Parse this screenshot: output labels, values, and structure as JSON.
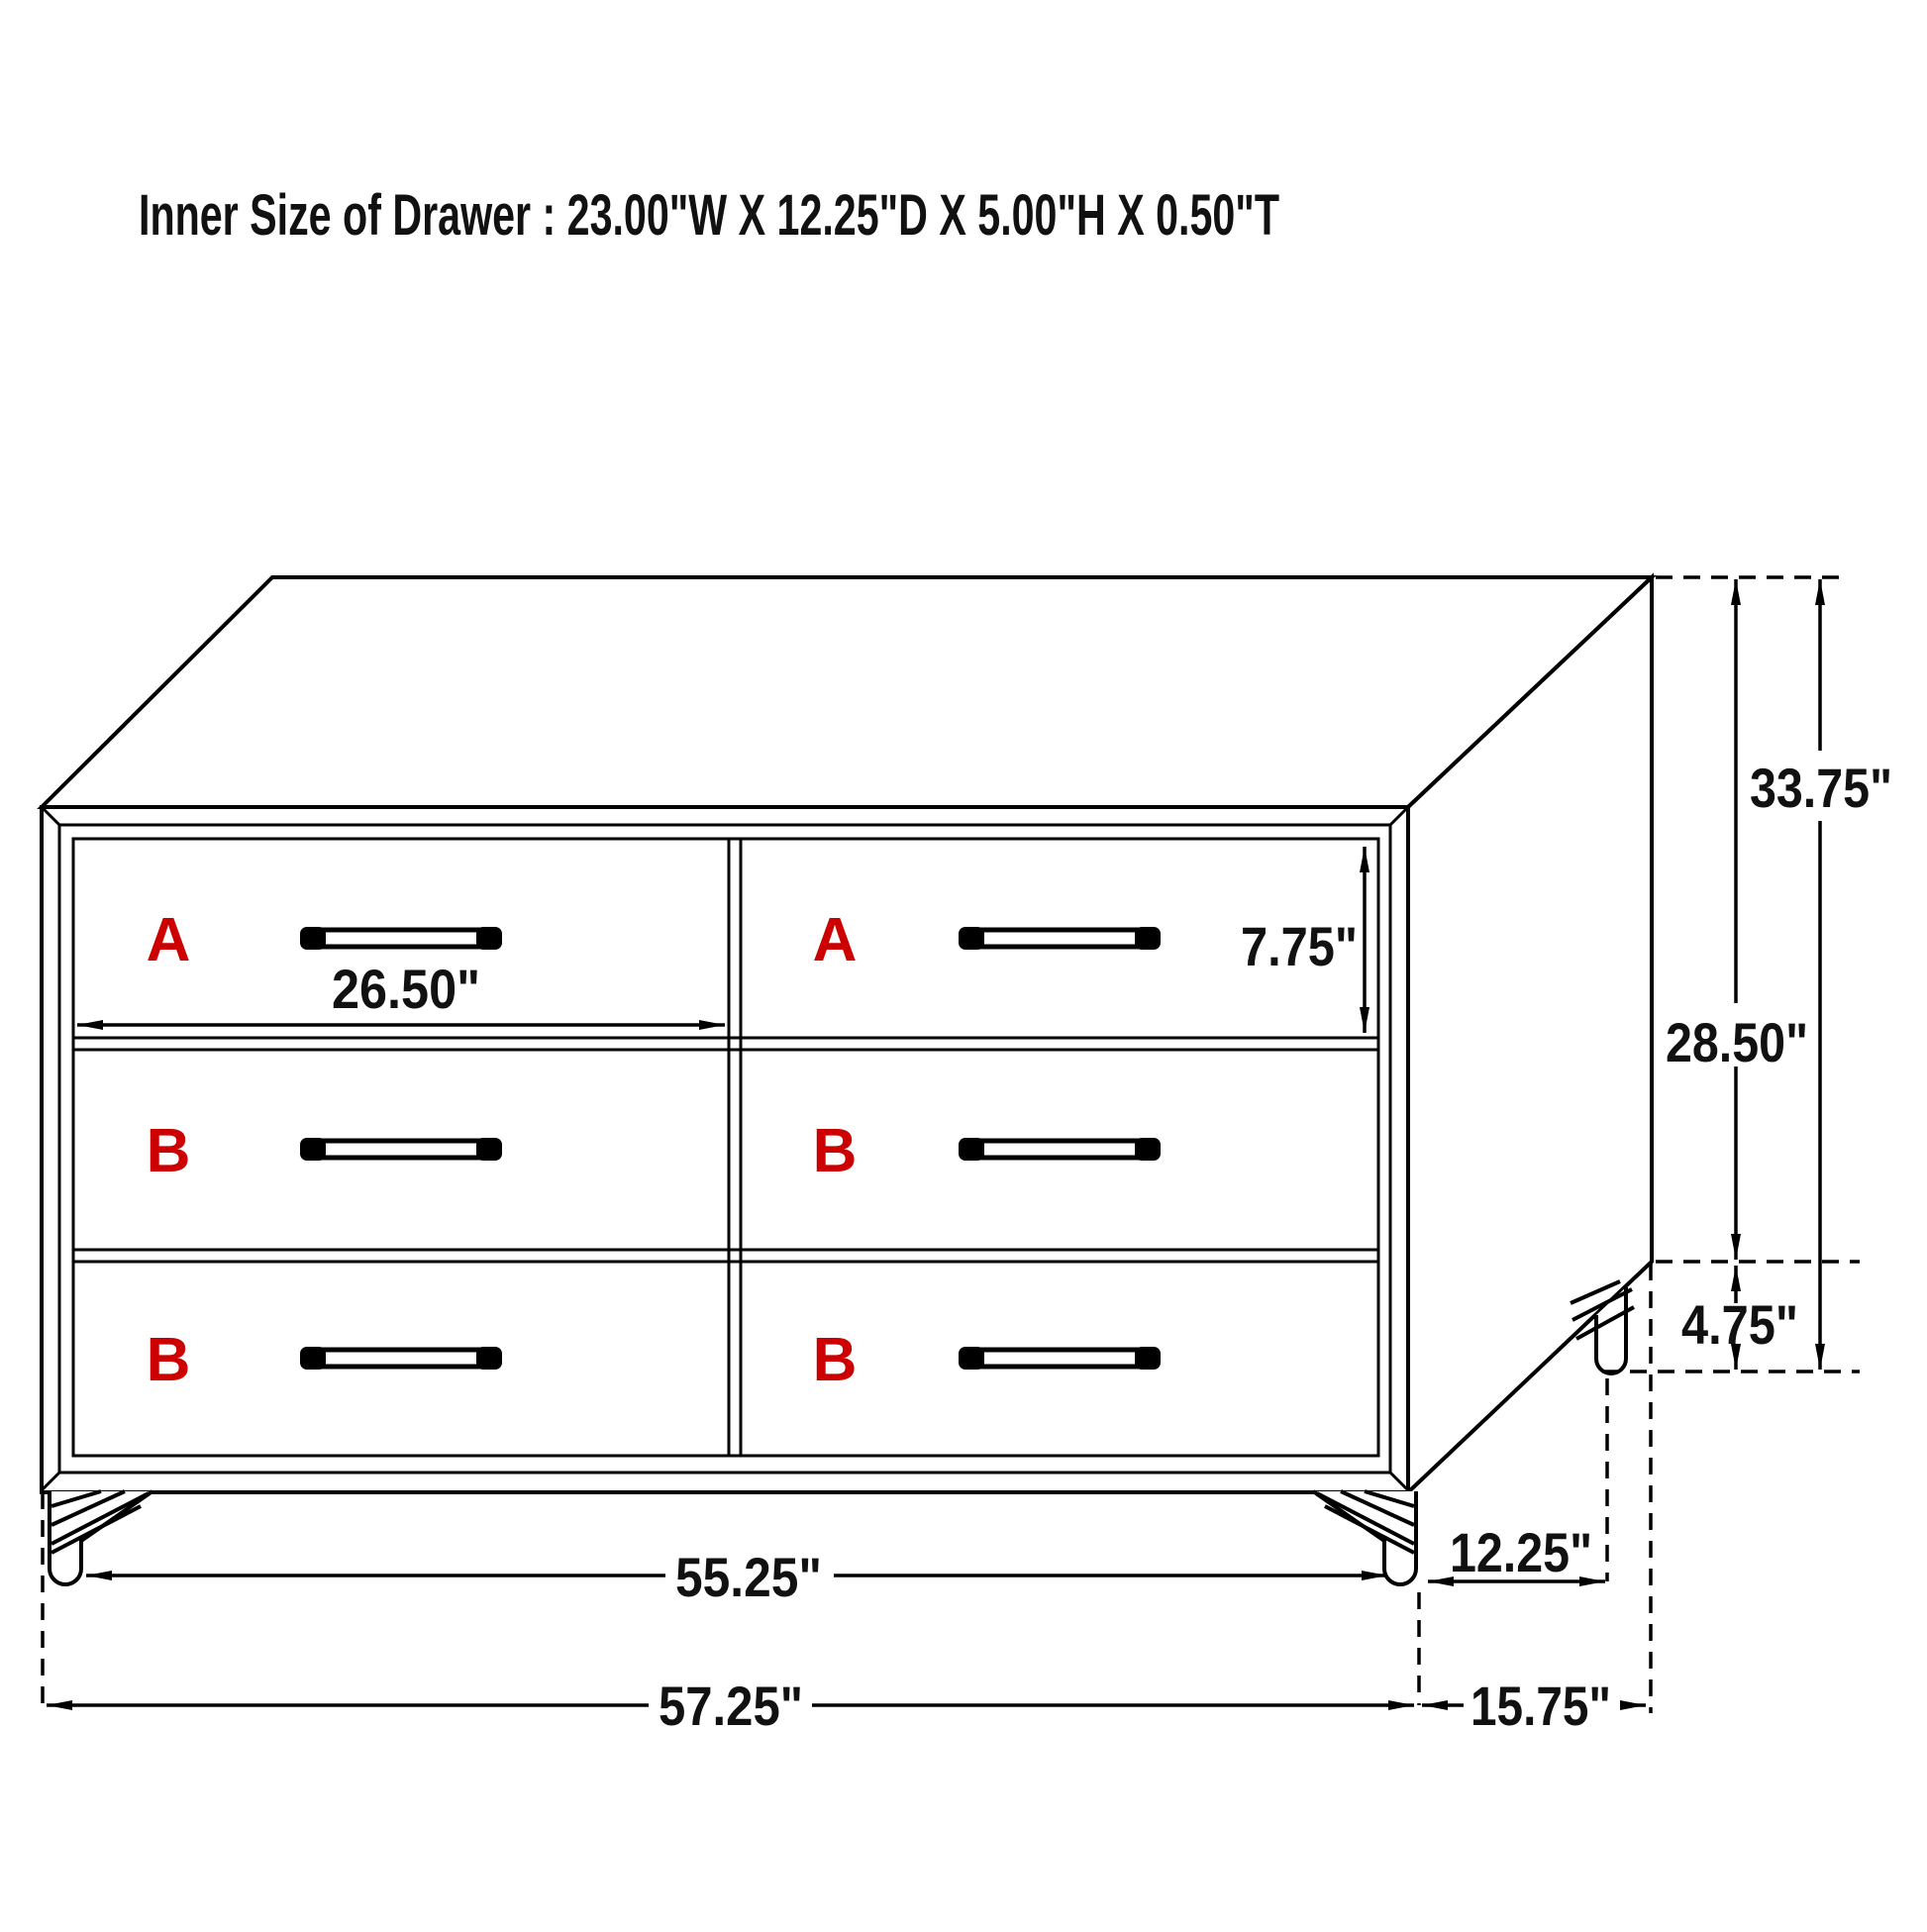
{
  "title": "Inner Size of Drawer : 23.00\"W X 12.25\"D X 5.00\"H X 0.50\"T",
  "colors": {
    "line": "#000000",
    "label_red": "#CC0000",
    "background": "#FFFFFF"
  },
  "cabinet": {
    "description": "6-drawer dresser, isometric technical line drawing with coil-spring legs",
    "drawers": [
      {
        "label": "A",
        "row": 1,
        "col": 1
      },
      {
        "label": "A",
        "row": 1,
        "col": 2
      },
      {
        "label": "B",
        "row": 2,
        "col": 1
      },
      {
        "label": "B",
        "row": 2,
        "col": 2
      },
      {
        "label": "B",
        "row": 3,
        "col": 1
      },
      {
        "label": "B",
        "row": 3,
        "col": 2
      }
    ]
  },
  "dimensions": {
    "drawer_front_width": {
      "label": "26.50\""
    },
    "drawer_front_height": {
      "label": "7.75\""
    },
    "overall_height": {
      "label": "33.75\""
    },
    "body_height": {
      "label": "28.50\""
    },
    "leg_height": {
      "label": "4.75\""
    },
    "front_leg_span": {
      "label": "55.25\""
    },
    "overall_width": {
      "label": "57.25\""
    },
    "side_leg_span": {
      "label": "12.25\""
    },
    "overall_depth": {
      "label": "15.75\""
    }
  }
}
